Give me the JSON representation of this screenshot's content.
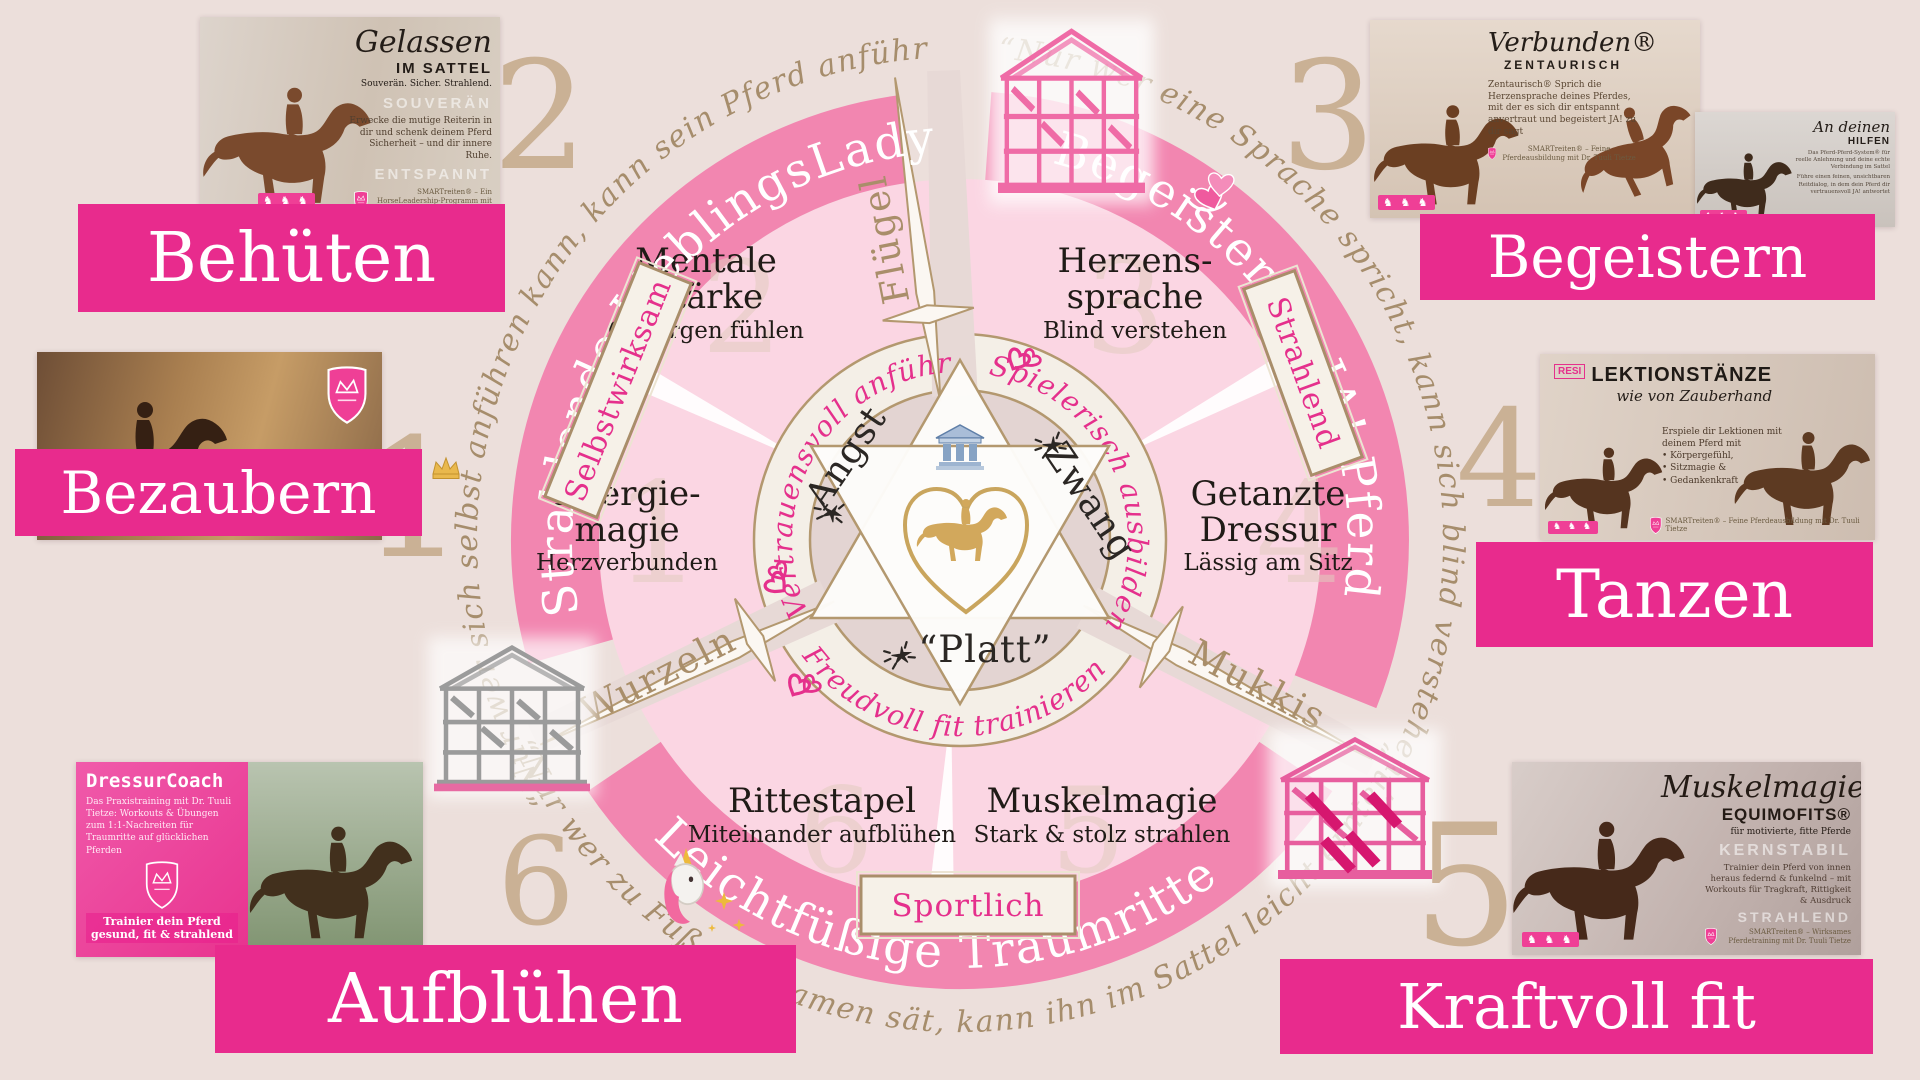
{
  "colors": {
    "background": "#ecdfdb",
    "banner_pink": "#e82b8d",
    "ring_pink": "#f286b0",
    "accent_pink": "#e5308c",
    "tan": "#a98e6a",
    "gold": "#d2a85c"
  },
  "banners": {
    "behueten": "Behüten",
    "bezaubern": "Bezaubern",
    "aufbluehen": "Aufblühen",
    "begeistern": "Begeistern",
    "tanzen": "Tanzen",
    "kraftvoll": "Kraftvoll fit"
  },
  "wheel": {
    "numerals": [
      "1",
      "2",
      "3",
      "4",
      "5",
      "6"
    ],
    "outer_arcs": {
      "left": {
        "label": "Strahlende LieblingsLady",
        "icon": "crown-icon"
      },
      "right": {
        "label": "Begeistertes JA!-Pferd",
        "icon": "double-hearts-icon"
      },
      "bottom": {
        "label": "Leichtfüßige Traumritte",
        "icon": "unicorn-icon"
      }
    },
    "inner_arcs": {
      "left": "Vertrauensvoll anführen",
      "right": "Spielerisch ausbilden",
      "bottom": "Freudvoll fit trainieren"
    },
    "badges": {
      "left": "Selbstwirksam",
      "right": "Strahlend",
      "bottom": "Sportlich"
    },
    "spokes": {
      "top": "Flügel",
      "lower_left": "Wurzeln",
      "lower_right": "Mukkis"
    },
    "blocked_words": {
      "left": "Angst",
      "right": "Zwang",
      "bottom": "“Platt”"
    },
    "quotes": {
      "left": "“Nur wer sich selbst anführen kann, kann sein Pferd anführen.”",
      "right": "“Nur wer eine Sprache spricht, kann sich blind verstehen.”",
      "bottom": "“Nur wer zu Fuß den Samen sät, kann ihn im Sattel leicht ernten.”"
    },
    "segments": [
      {
        "num": "1",
        "title_lines": [
          "Energie-",
          "magie"
        ],
        "subtitle": "Herzverbunden"
      },
      {
        "num": "2",
        "title_lines": [
          "Mentale",
          "Stärke"
        ],
        "subtitle": "Geborgen fühlen"
      },
      {
        "num": "3",
        "title_lines": [
          "Herzens-",
          "sprache"
        ],
        "subtitle": "Blind verstehen"
      },
      {
        "num": "4",
        "title_lines": [
          "Getanzte",
          "Dressur"
        ],
        "subtitle": "Lässig am Sitz"
      },
      {
        "num": "5",
        "title_lines": [
          "Muskelmagie"
        ],
        "subtitle": "Stark & stolz strahlen"
      },
      {
        "num": "6",
        "title_lines": [
          "Rittestapel"
        ],
        "subtitle": "Miteinander aufblühen"
      }
    ]
  },
  "shared": {
    "horses_logo": "♞ ♞ ♞"
  },
  "products": {
    "gelassen": {
      "title_script": "Gelassen",
      "title_caps": "IM SATTEL",
      "tagline": "Souverän. Sicher. Strahlend.",
      "ghost_1": "SOUVERÄN",
      "ghost_2": "ENTSPANNT",
      "body": "Erwecke die mutige Reiterin in dir und schenk deinem Pferd Sicherheit – und dir innere Ruhe.",
      "footer": "SMARTreiten® – Ein HorseLeadership-Programm mit Dr. Tuuli Tietze & Lara Bauer"
    },
    "einssein": {
      "title_script": "Einssein",
      "title_caps": "ELIXIER"
    },
    "dressurcoach": {
      "title": "DressurCoach",
      "body": "Das Praxistraining mit Dr. Tuuli Tietze: Workouts & Übungen zum 1:1-Nachreiten für Traumritte auf glücklichen Pferden",
      "caption": "Trainier dein Pferd gesund, fit & strahlend"
    },
    "verbunden": {
      "title_script": "Verbunden®",
      "title_caps": "ZENTAURISCH",
      "body": "Zentaurisch® Sprich die Herzensprache deines Pferdes, mit der es sich dir entspannt anvertraut und begeistert JA! zu dir sagt",
      "footer": "SMARTreiten® – Feine Pferdeausbildung mit Dr. Tuuli Tietze"
    },
    "hilfen": {
      "title_script": "An deinen",
      "title_caps": "HILFEN",
      "sub": "Das Pferd-Pferd-System® für reelle Anlehnung und deine echte Verbindung im Sattel",
      "body": "Führe einen feinen, unsichtbaren Reitdialog, in dem dein Pferd dir vertrauensvoll JA! antwortet"
    },
    "lektionstaenze": {
      "logo": "RESI",
      "title_caps": "LEKTIONSTÄNZE",
      "title_script": "wie von Zauberhand",
      "body_intro": "Erspiele dir Lektionen mit deinem Pferd mit",
      "bullets": [
        "• Körpergefühl,",
        "• Sitzmagie &",
        "• Gedankenkraft"
      ],
      "footer": "SMARTreiten® – Feine Pferdeausbildung mit Dr. Tuuli Tietze"
    },
    "muskelmagie": {
      "title_script": "Muskelmagie",
      "title_caps": "EQUIMOFITS®",
      "sub": "für motivierte, fitte Pferde",
      "ghost_1": "KERNSTABIL",
      "ghost_2": "STRAHLEND",
      "body": "Trainier dein Pferd von innen heraus federnd & funkelnd – mit Workouts für Tragkraft, Rittigkeit & Ausdruck",
      "footer": "SMARTreiten® – Wirksames Pferdetraining mit Dr. Tuuli Tietze"
    }
  }
}
